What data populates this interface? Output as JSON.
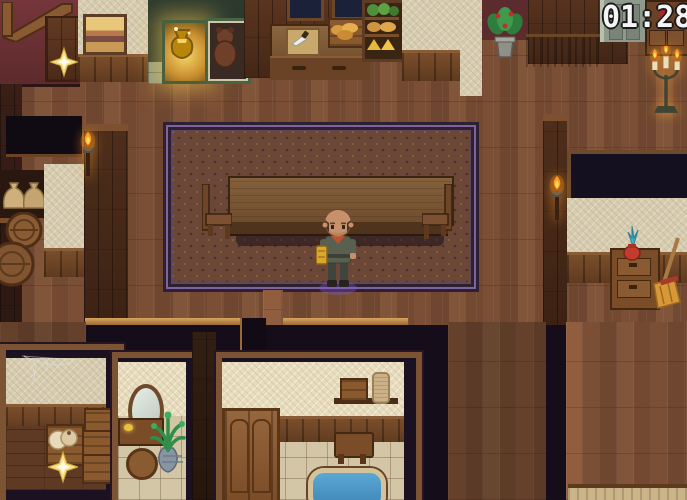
{
  "hud": {
    "timer": "01:28"
  },
  "scene": {
    "objects": [
      "landscape-painting",
      "golden-artifact-case",
      "creature-display-case",
      "kitchen-window-left",
      "kitchen-window-right",
      "kitchen-counter",
      "cutting-board-with-knife",
      "bread-crate",
      "food-shelf",
      "kitchen-chair",
      "potted-flower-plant",
      "purple-wall-tapestry",
      "stone-door",
      "wooden-cabinet",
      "candelabra",
      "storeroom-torch",
      "right-wall-torch",
      "sack-shelf",
      "storage-barrels",
      "ornate-rug",
      "long-dining-table",
      "dining-chair-left",
      "dining-chair-right",
      "player-character",
      "dark-window",
      "nightstand",
      "flower-vase",
      "broom",
      "sparkle-top-left",
      "sparkle-storeroom",
      "cobweb",
      "jug-crate",
      "crate-stack",
      "vanity-mirror",
      "vanity-table",
      "vanity-stool",
      "palm-plant",
      "bath-shelf",
      "wooden-box",
      "towel-jar",
      "folding-screen",
      "bath-side-table",
      "bathtub",
      "bed-edge"
    ]
  },
  "colors": {
    "floor_wood": "#744a31",
    "wall_wood_dark": "#432818",
    "wall_beige": "#d7ccb0",
    "wall_red": "#6d3134",
    "rug_base": "#6b4738",
    "rug_border_purple": "#7e639c",
    "tile_floor": "#d3c6a6",
    "water_blue": "#3e86b6",
    "flame_orange": "#ff9d20",
    "sparkle_gold": "#f8df82",
    "timer_text": "#f5f5f5",
    "timer_outline": "#1a1a1a",
    "shadow_dark": "#160d1a"
  }
}
